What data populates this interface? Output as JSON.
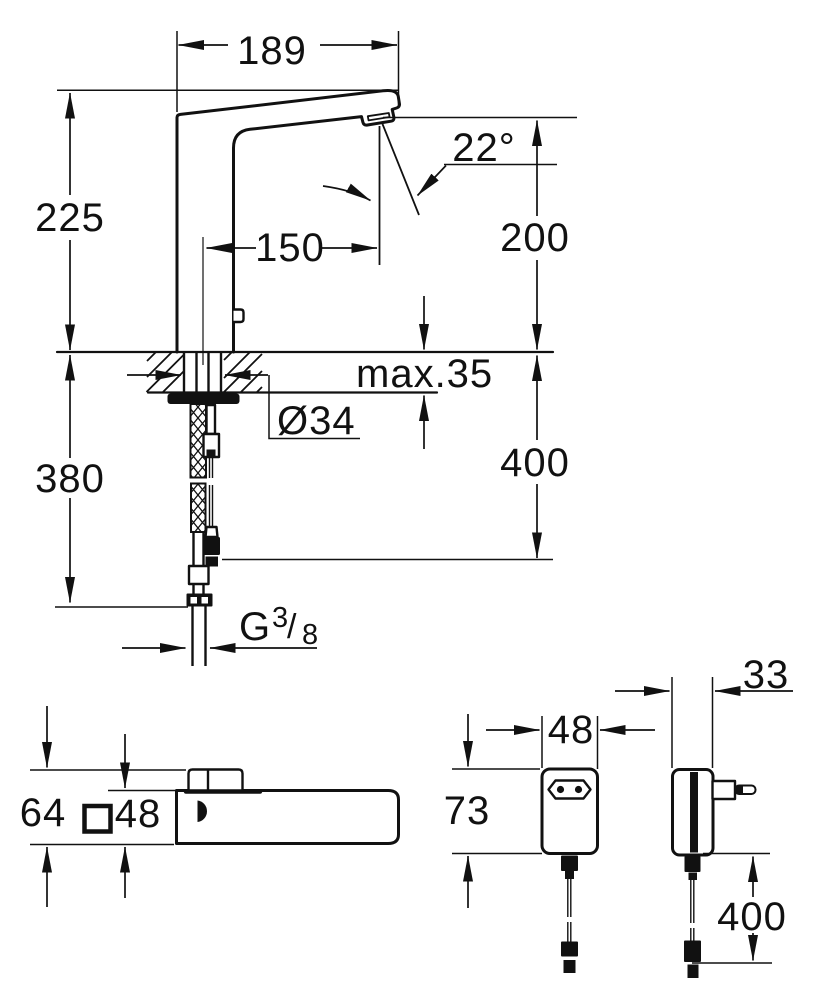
{
  "colors": {
    "ink": "#111111",
    "bg": "#ffffff"
  },
  "views": {
    "faucet_side": {
      "spout_reach": "189",
      "body_height": "225",
      "spout_projection": "150",
      "spray_angle": "22°",
      "outlet_height": "200",
      "max_deck_thickness": "max.35",
      "hole_diameter": "Ø34",
      "hose_drop": "380",
      "cable_drop": "400",
      "thread_prefix": "G",
      "thread_numerator": "3",
      "thread_slash": "/",
      "thread_denominator": "8"
    },
    "faucet_top": {
      "overall_depth": "64",
      "base_square": "48"
    },
    "power_supply_front": {
      "width": "48",
      "height": "73"
    },
    "power_supply_side": {
      "depth": "33",
      "cable_length": "400"
    }
  }
}
